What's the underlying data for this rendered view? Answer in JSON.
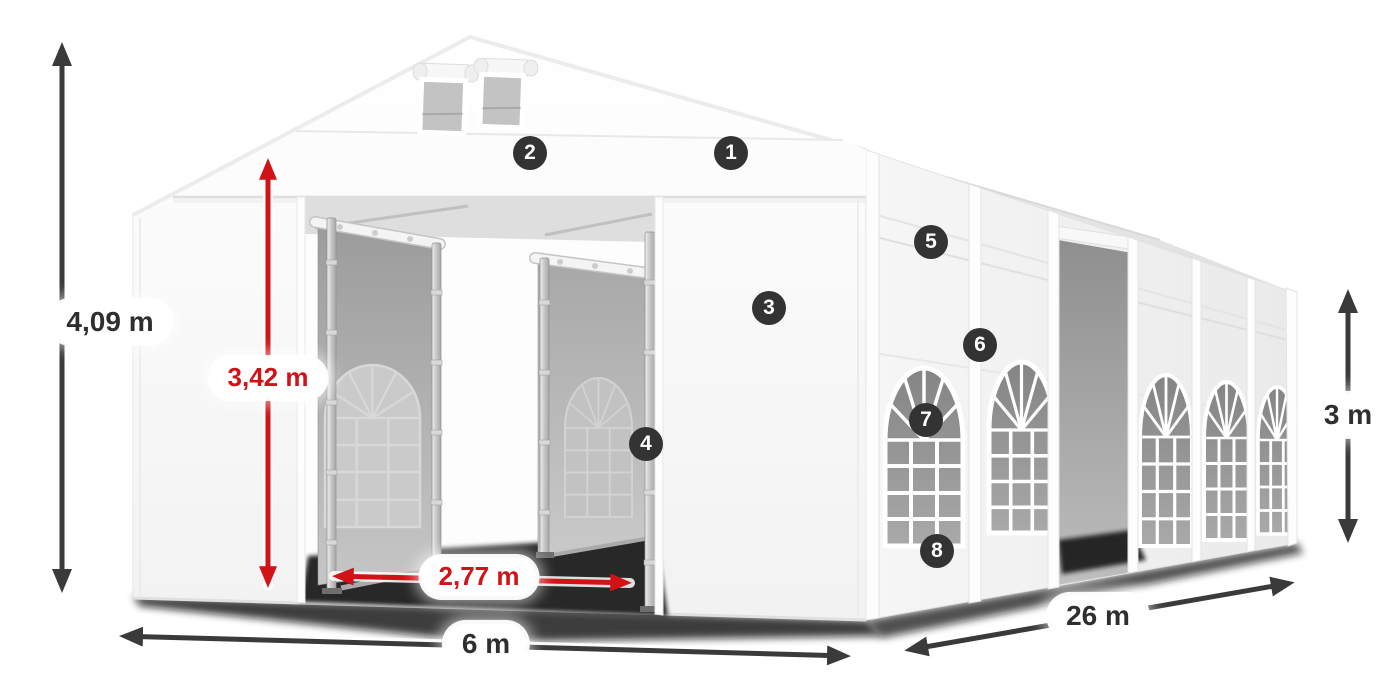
{
  "product": {
    "kind": "tent-dimension-diagram"
  },
  "dimensions": {
    "total_height": {
      "label": "4,09 m",
      "arrow_color": "#3a3a3a"
    },
    "inner_height": {
      "label": "3,42 m",
      "arrow_color": "#d11216"
    },
    "door_width": {
      "label": "2,77 m",
      "arrow_color": "#d11216"
    },
    "width": {
      "label": "6 m",
      "arrow_color": "#3a3a3a"
    },
    "length": {
      "label": "26 m",
      "arrow_color": "#3a3a3a"
    },
    "side_height": {
      "label": "3 m",
      "arrow_color": "#3a3a3a"
    }
  },
  "callouts": [
    {
      "number": "1"
    },
    {
      "number": "2"
    },
    {
      "number": "3"
    },
    {
      "number": "4"
    },
    {
      "number": "5"
    },
    {
      "number": "6"
    },
    {
      "number": "7"
    },
    {
      "number": "8"
    }
  ],
  "colors": {
    "dark_arrow": "#3a3a3a",
    "red_arrow": "#d11216",
    "badge_background": "#333333",
    "badge_number": "#ffffff",
    "label_text_dark": "#2e2e2e",
    "label_text_red": "#d11216",
    "tent_fabric": "#f7f7f7",
    "interior_fabric": "#b3b3b3",
    "window_glass": "#8e8e8e",
    "ground_shadow": "#141414"
  }
}
